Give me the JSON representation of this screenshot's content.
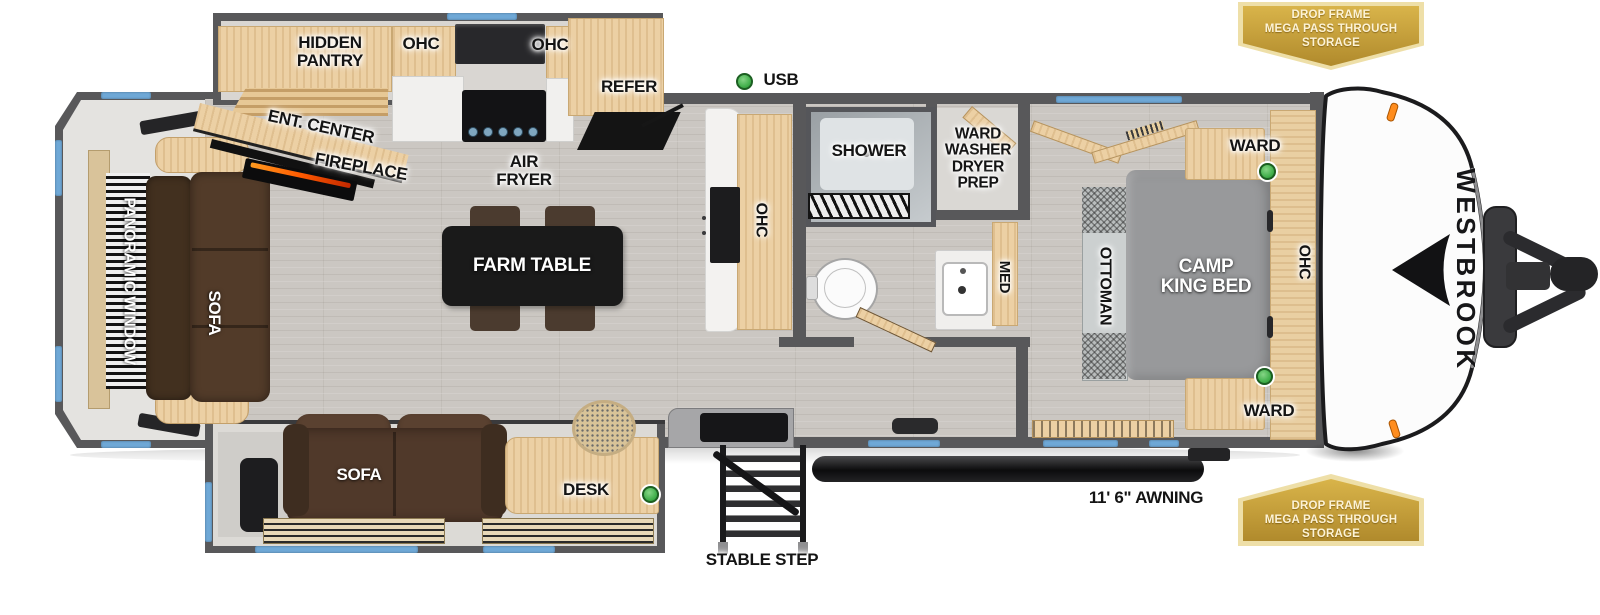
{
  "brand": {
    "name": "WESTBROOK"
  },
  "badges": {
    "lines": [
      "DROP FRAME",
      "MEGA PASS THROUGH",
      "STORAGE"
    ]
  },
  "callouts": {
    "usb": "USB",
    "awning": "11' 6\" AWNING",
    "stable_step": "STABLE STEP"
  },
  "kitchen": {
    "hidden_pantry": [
      "HIDDEN",
      "PANTRY"
    ],
    "ohc_left": "OHC",
    "ohc_mid": "OHC",
    "refer": "REFER",
    "air_fryer": [
      "AIR",
      "FRYER"
    ],
    "ent_center": "ENT. CENTER",
    "fireplace": "FIREPLACE",
    "island_ohc": "OHC",
    "farm_table": "FARM TABLE"
  },
  "living": {
    "panoramic_window": "PANORAMIC WINDOW",
    "rear_sofa": "SOFA",
    "slide_sofa": "SOFA",
    "desk": "DESK"
  },
  "bath": {
    "shower": "SHOWER",
    "ward_washer": [
      "WARD",
      "WASHER",
      "DRYER",
      "PREP"
    ],
    "med": "MED"
  },
  "bedroom": {
    "ward_top": "WARD",
    "ward_bottom": "WARD",
    "ottoman": "OTTOMAN",
    "bed": [
      "CAMP",
      "KING BED"
    ],
    "ohc": "OHC"
  },
  "colors": {
    "wall": "#58585a",
    "floor_wood": "#cbc7c2",
    "cabinet_wood": "#ecd0a4",
    "window_blue": "#6fa8d6",
    "usb_green": "#3fae49",
    "badge_gold": "#c9a53e",
    "sofa_brown": "#50392a"
  }
}
